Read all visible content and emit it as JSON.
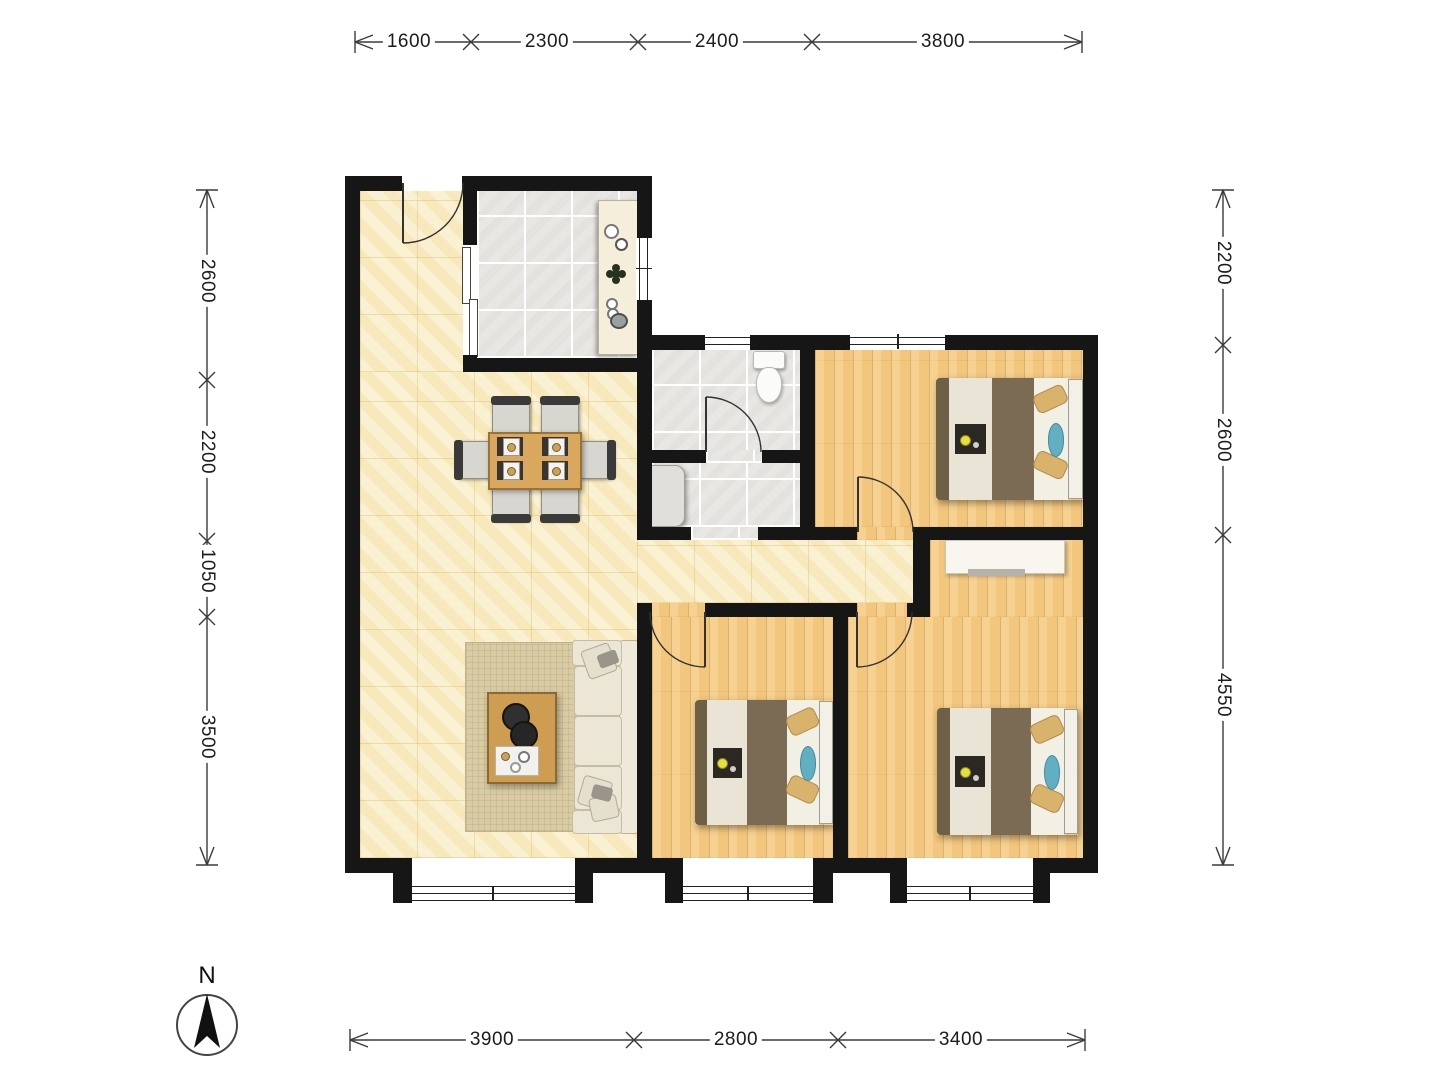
{
  "compass": {
    "label": "N"
  },
  "dimensions": {
    "top": [
      {
        "label": "1600"
      },
      {
        "label": "2300"
      },
      {
        "label": "2400"
      },
      {
        "label": "3800"
      }
    ],
    "left": [
      {
        "label": "2600"
      },
      {
        "label": "2200"
      },
      {
        "label": "1050"
      },
      {
        "label": "3500"
      }
    ],
    "right": [
      {
        "label": "2200"
      },
      {
        "label": "2600"
      },
      {
        "label": "4550"
      }
    ],
    "bottom": [
      {
        "label": "3900"
      },
      {
        "label": "2800"
      },
      {
        "label": "3400"
      }
    ]
  },
  "palette": {
    "wall": "#161616",
    "floor_cream_tile": "#f8edc5",
    "floor_gray_tile": "#e9e7e3",
    "floor_wood": "#f2c67d",
    "bed_duvet_brown": "#7b6b54",
    "bed_pillow_tan": "#d9b26c",
    "bed_cushion_blue": "#62aec2",
    "sofa_cream": "#ece6d6",
    "dining_table_wood": "#d9a85e",
    "rug_beige": "#d9cba4"
  }
}
